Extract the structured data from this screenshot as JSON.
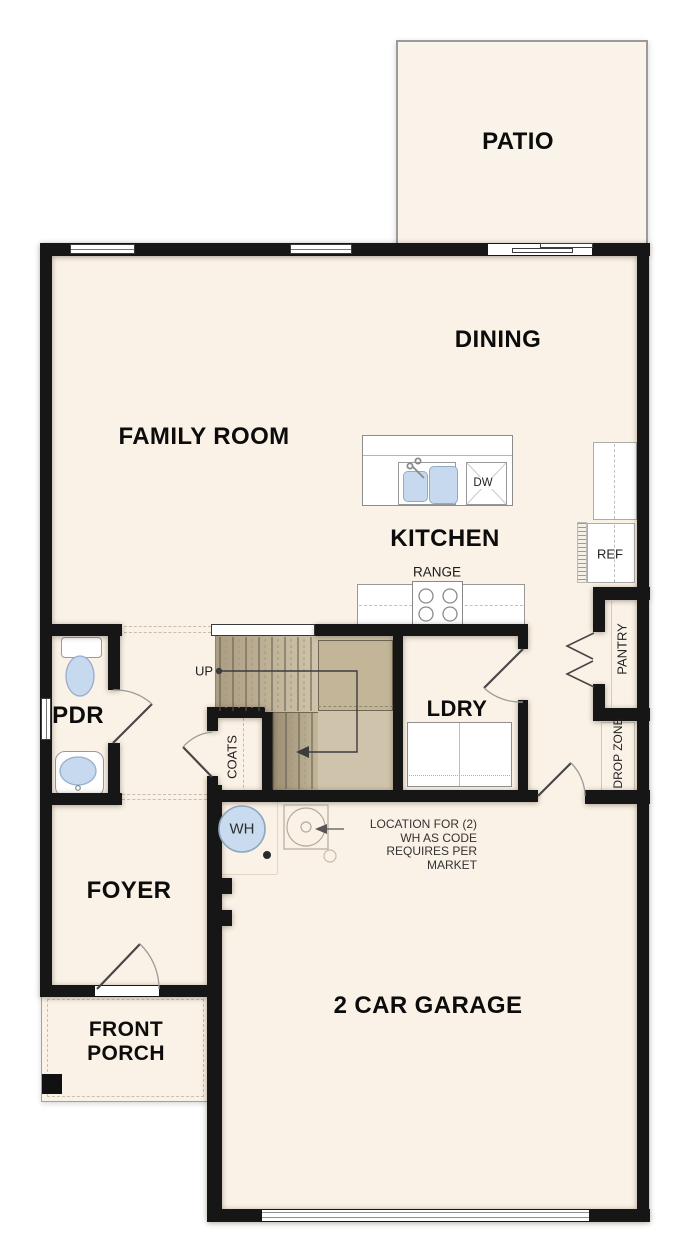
{
  "rooms": {
    "patio": "PATIO",
    "dining": "DINING",
    "family_room": "FAMILY ROOM",
    "kitchen": "KITCHEN",
    "laundry": "LDRY",
    "powder": "PDR",
    "foyer": "FOYER",
    "porch_line1": "FRONT",
    "porch_line2": "PORCH",
    "garage": "2 CAR GARAGE"
  },
  "features": {
    "range": "RANGE",
    "dishwasher": "DW",
    "refrigerator": "REF",
    "pantry": "PANTRY",
    "drop_zone": "DROP ZONE",
    "coats": "COATS",
    "stairs_up": "UP",
    "water_heater": "WH"
  },
  "annotation": {
    "line1": "LOCATION FOR (2)",
    "line2": "WH AS CODE",
    "line3": "REQUIRES PER",
    "line4": "MARKET"
  },
  "colors": {
    "floor": "#faf2e6",
    "wall": "#161616",
    "stair_tread_dark": "#a89a7e",
    "stair_tread_light": "#cfc4aa",
    "fixture_blue": "#c6d9ee",
    "outline_gray": "#999999"
  }
}
